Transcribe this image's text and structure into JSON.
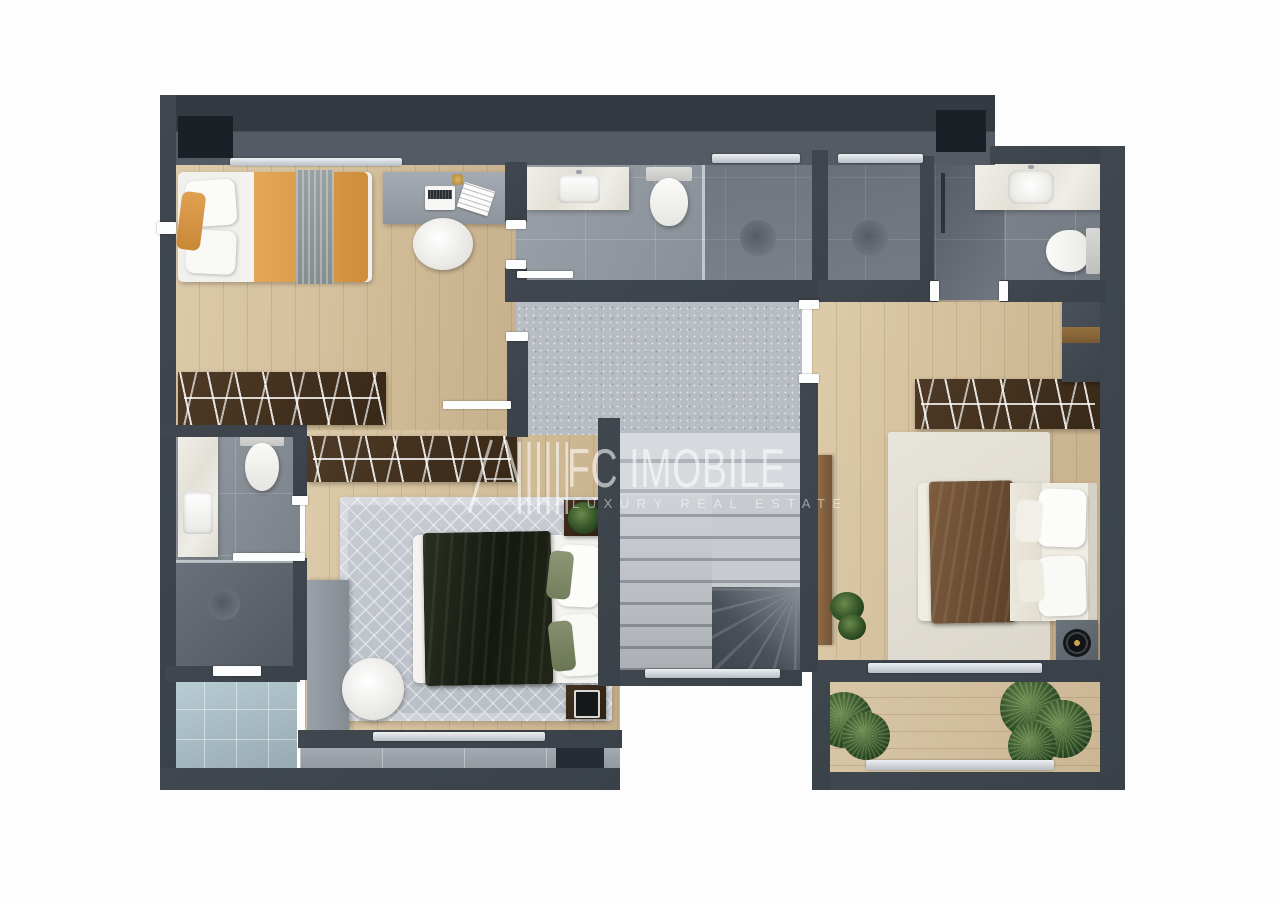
{
  "scene": {
    "kind": "floor-plan-3d-render-top-view",
    "floor": "upper-floor-apartment"
  },
  "watermark": {
    "brand": "FC IMOBILE",
    "tagline": "LUXURY REAL ESTATE",
    "logo": "striped-house-logo",
    "text_color": "#ffffff",
    "opacity": 0.55
  },
  "palette": {
    "background": "#ffffff",
    "wall": "#3d444c",
    "wall_inner_face": "#565d66",
    "wood_floor": "#d5c2a0",
    "bathroom_tile": "#8d949c",
    "terrace_tile": "#a9bcc4",
    "carpet_landing": "#b8bdc3",
    "stairs_light": "#ccd0d5",
    "stairs_dark": "#454c54",
    "wardrobe_wood": "#46331f",
    "bedding_orange": "#de9b4a",
    "blanket_dark_green": "#23281c",
    "blanket_brown": "#7a5a3e",
    "rug_gray": "#c3c9cf",
    "rug_cream": "#e2dfd5",
    "plant_green": "#3c5a30",
    "ceramic_white": "#f8f8f6"
  },
  "regions": [
    "bedroom-top-left",
    "shared-bathroom-top",
    "shower-stall-1",
    "shower-stall-2",
    "ensuite-bathroom-right",
    "walk-in-closet",
    "bathroom-left",
    "bedroom-bottom-left",
    "stair-landing",
    "staircase",
    "master-bedroom",
    "balcony-bottom-right",
    "terrace-bottom-left"
  ],
  "furniture": [
    "single-bed-orange",
    "desk-with-laptop",
    "round-chair",
    "vanity-sink",
    "toilet",
    "walk-in-shower",
    "hanger-wardrobe",
    "double-bed-dark-blanket",
    "double-bed-brown-blanket",
    "nightstand-with-plant",
    "nightstand-with-speaker",
    "area-rug",
    "potted-plants",
    "tall-cabinet",
    "wood-console"
  ]
}
